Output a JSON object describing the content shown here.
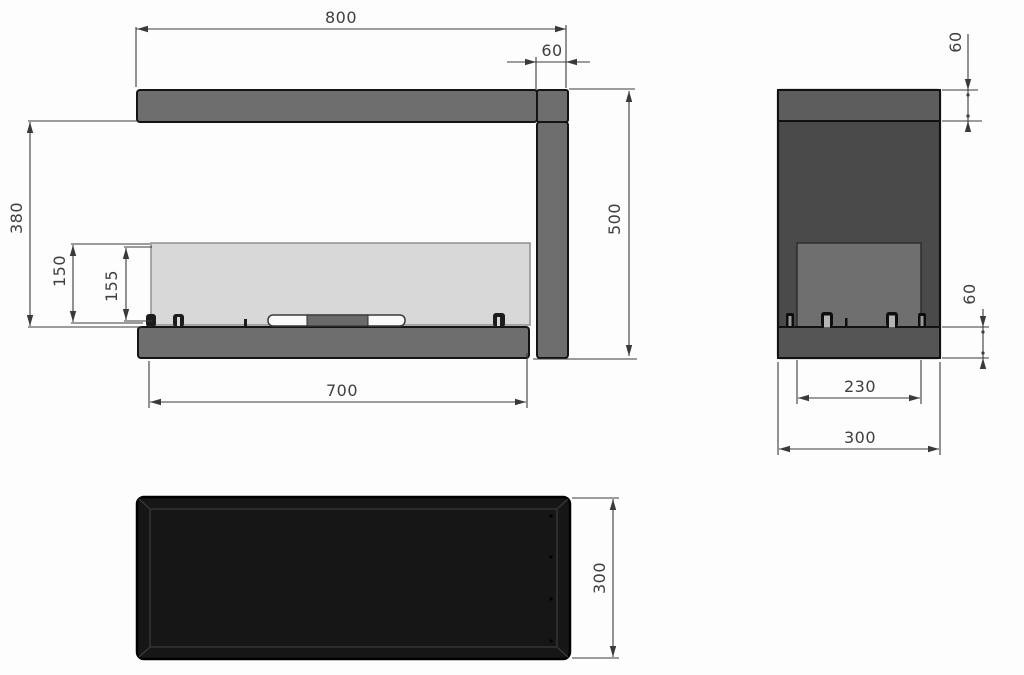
{
  "dims": {
    "front": {
      "overall_width": "800",
      "frame_depth": "60",
      "inner_height": "380",
      "glass_height": "150",
      "opening_height": "155",
      "overall_height": "500",
      "opening_width": "700"
    },
    "side": {
      "top_frame": "60",
      "bottom_frame": "60",
      "inner_depth": "230",
      "overall_depth": "300"
    },
    "bottom": {
      "depth": "300"
    }
  },
  "colors": {
    "background": "#fdfdfd",
    "frame_gray": "#6e6e6e",
    "side_top_strip": "#5d5d5d",
    "side_body": "#4a4a4a",
    "side_inner_panel": "#6f6f6f",
    "side_bottom_strip": "#555555",
    "glass": "#d8d8d8",
    "burner_tray": "#fafafa",
    "burner_center": "#6a6a6a",
    "tray_black": "#161616",
    "dim_line": "#3a3a3a",
    "dim_text": "#3f3f3f"
  }
}
